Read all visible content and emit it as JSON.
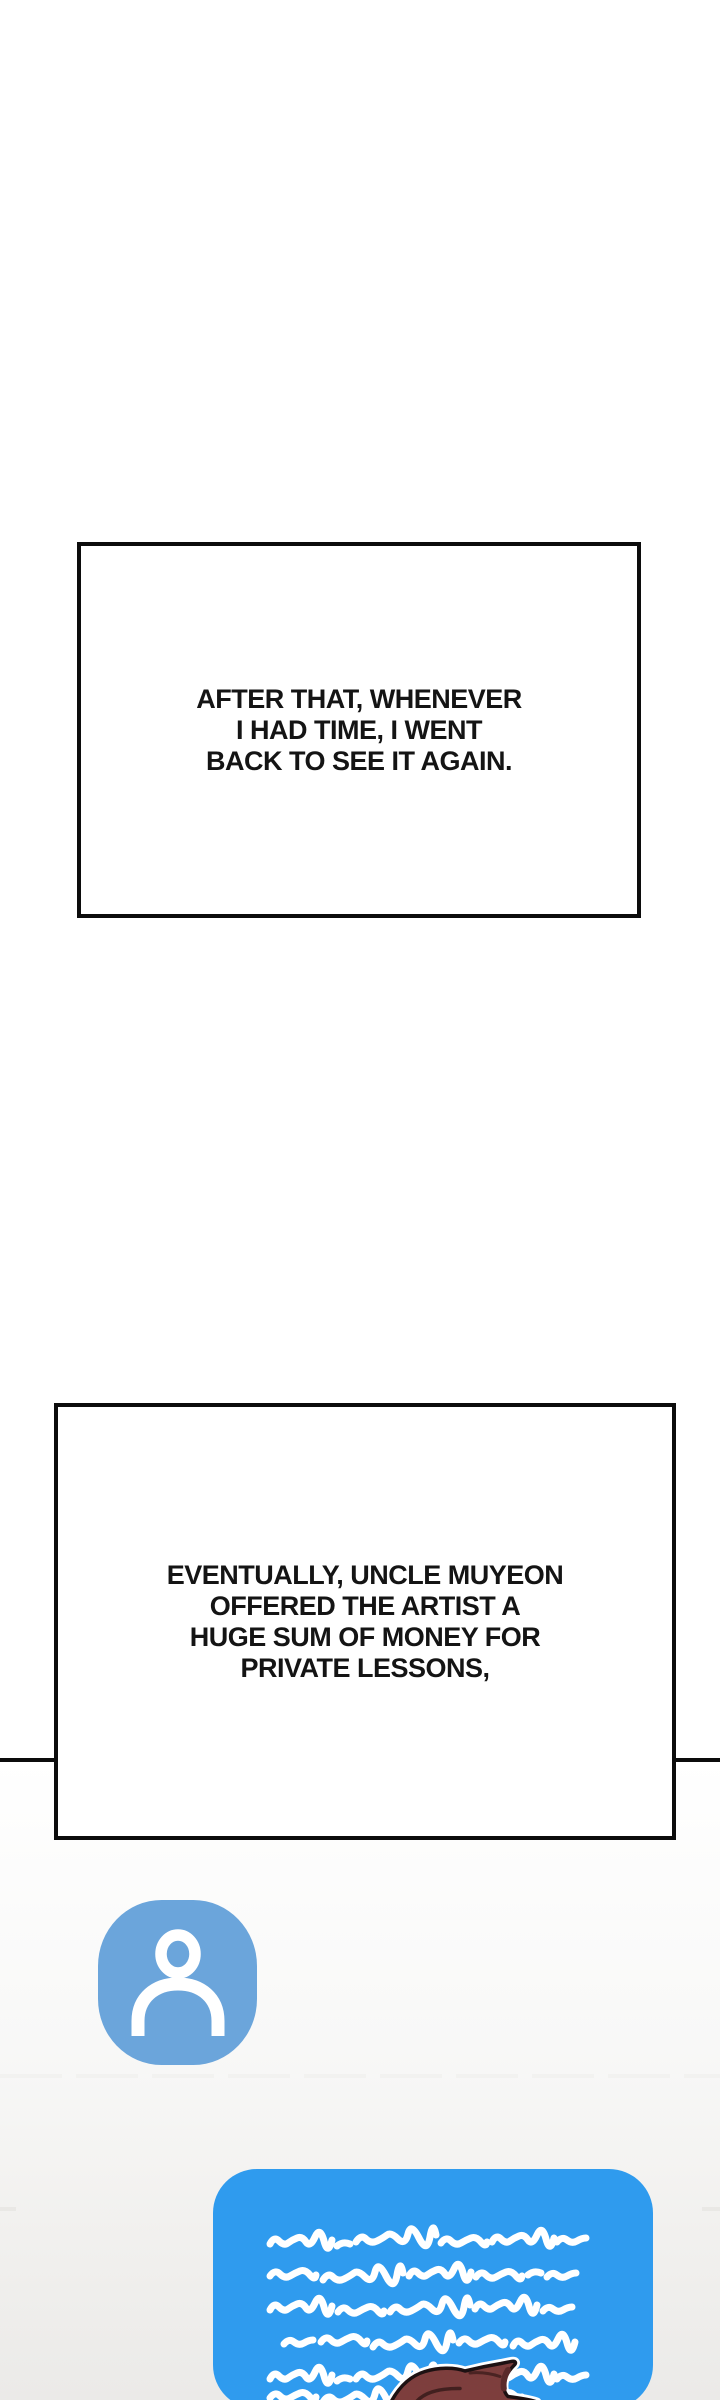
{
  "page": {
    "kind": "webtoon-comic-strip",
    "background_color": "#FFFFFF"
  },
  "panels": [
    {
      "name": "caption-panel-1",
      "lines": [
        "AFTER THAT, WHENEVER",
        "I HAD TIME, I WENT",
        "BACK TO SEE IT AGAIN."
      ]
    },
    {
      "name": "caption-panel-2",
      "lines": [
        "EVENTUALLY, UNCLE MUYEON",
        "OFFERED THE ARTIST A",
        "HUGE SUM OF MONEY FOR",
        "PRIVATE LESSONS,"
      ]
    }
  ],
  "divider": {
    "description": "black horizontal rule crossing the page behind caption panel 2"
  },
  "chat_scene": {
    "avatar": {
      "icon": "person-icon",
      "background_color": "#6BA5DB",
      "glyph_color": "#FFFFFF"
    },
    "bubble": {
      "background_color": "#2F9BEE",
      "content": "illegible handwritten white scribble lines (a long message / letter)",
      "scribble_color": "#FFFFFF"
    },
    "character": {
      "description": "top of a character's head with a hair spike, cut off by bottom edge",
      "hair_color": "#7D3E3D",
      "hair_shadow_color": "#5A2A2A",
      "outline_color": "#1D1112"
    }
  },
  "colors": {
    "panel_border": "#0C0C0C",
    "caption_text": "#141414",
    "background_bottom": "#EBEAE8"
  }
}
